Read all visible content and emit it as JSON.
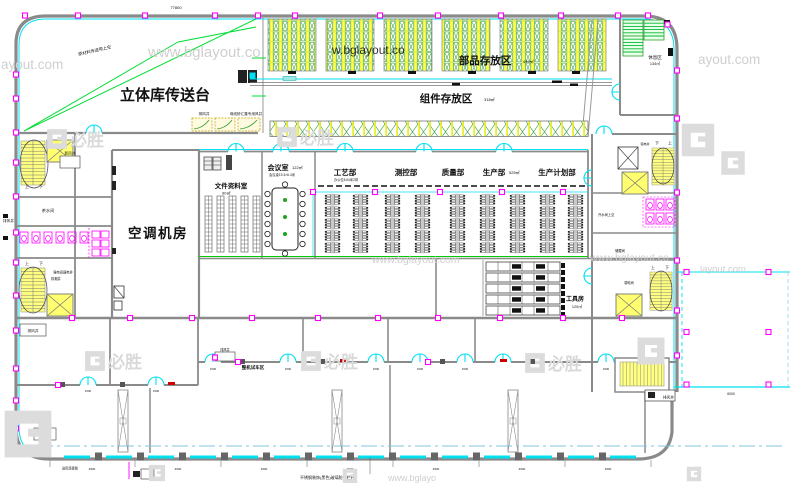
{
  "watermarks": {
    "url": "www.bglayout.com",
    "url_mid": "www.bglayout.co",
    "url_faint": "w.bglayout.co",
    "url_tail": "ayout.com",
    "url_tail2": "layout.com",
    "url_short": "www.bglayo",
    "brand": "必胜"
  },
  "rooms": {
    "conveyor_platform": "立体库传送台",
    "parts_storage": "部品存放区",
    "parts_storage_area": "449㎡",
    "component_storage": "组件存放区",
    "component_storage_area": "318㎡",
    "rest_area": "休息区",
    "rest_area_size": "134㎡",
    "hvac_room": "空调机房",
    "document_room": "文件资料室",
    "document_room_area": "90㎡",
    "meeting_room": "会议室",
    "meeting_room_area": "122㎡",
    "meeting_room_note": "会议桌19.3×6.4米",
    "dept_process": "工艺部",
    "dept_process_note": "办公位8.64米2排",
    "dept_measurement": "测控部",
    "dept_quality": "质量部",
    "dept_production": "生产部",
    "dept_production_area": "525㎡",
    "dept_planning": "生产计划部",
    "tool_room": "工具房",
    "tool_room_area": "120㎡",
    "test_area": "整机试车区",
    "tea_room": "茶水间",
    "water_room": "开水间上空",
    "storage_room": "储藏间"
  },
  "shafts": {
    "exhaust": "排风井",
    "fresh_air": "新风井",
    "smoke": "排烟井",
    "electrical": "强电间弱电井",
    "strong_electric": "强电井",
    "weak_electric": "弱电间",
    "busbar": "母线桥汇集专用风井"
  },
  "stairs": {
    "up": "上",
    "down": "下"
  },
  "annotations": {
    "raw_material": "原材料传送带上空",
    "railing": "不锈钢装饰(黑色)玻璃防护栏杆",
    "duct": "送风连接管"
  },
  "dimensions": {
    "top": "77800",
    "bay": "4500",
    "annex": "6000",
    "door": "1500"
  }
}
